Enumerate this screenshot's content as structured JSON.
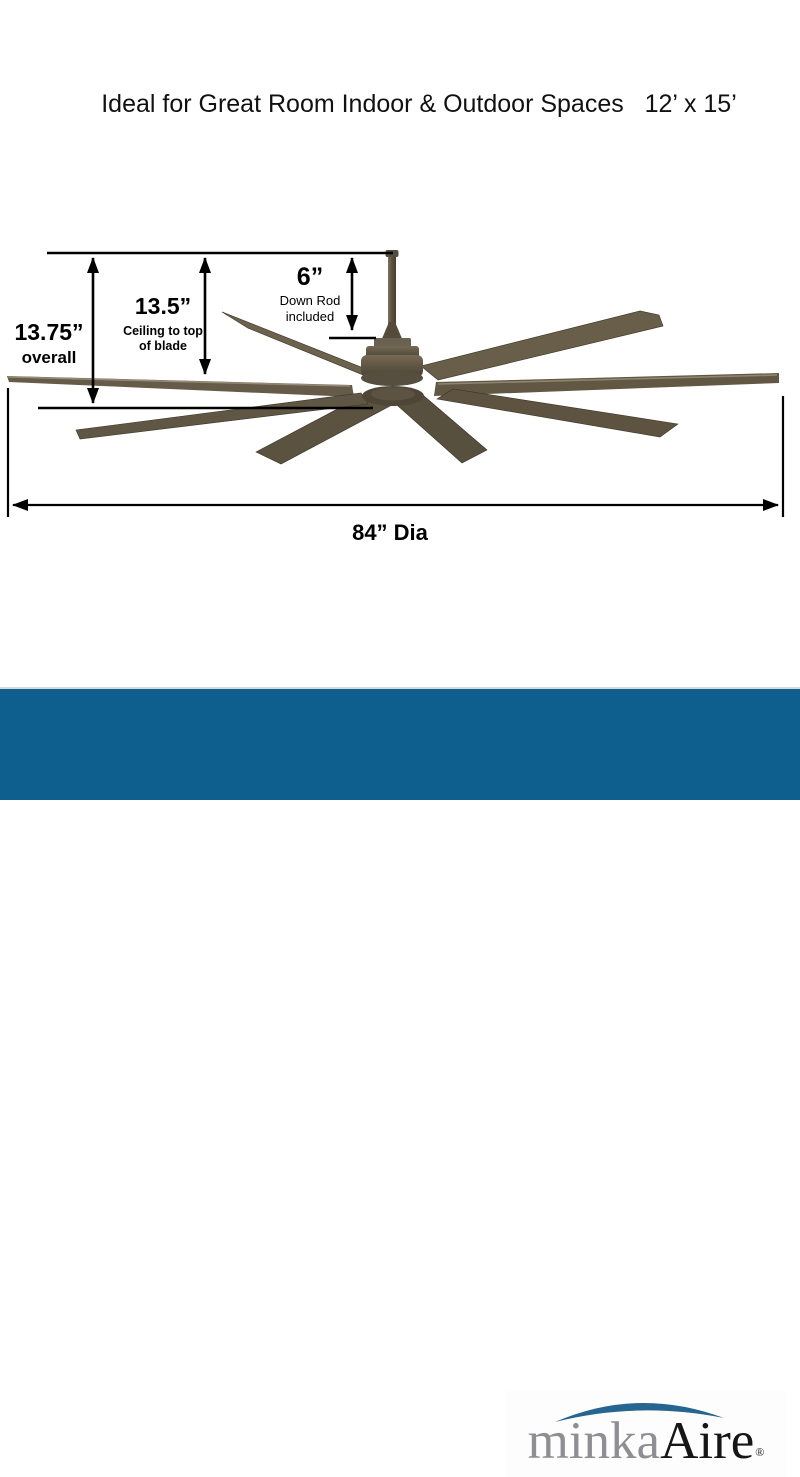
{
  "title": "Ideal for Great Room Indoor & Outdoor Spaces   12’ x 15’",
  "dimensions": {
    "down_rod": {
      "value": "6”",
      "line1": "Down Rod",
      "line2": "included"
    },
    "ceiling_to_blade": {
      "value": "13.5”",
      "line1": "Ceiling to top",
      "line2": "of blade"
    },
    "overall": {
      "value": "13.75”",
      "label": "overall"
    },
    "diameter": {
      "value": "84” Dia"
    }
  },
  "product": {
    "kind": "ceiling-fan-dimension-diagram",
    "blade_count": 8,
    "finish_color": "#5f5747"
  },
  "colors": {
    "dimension_lines": "#000000",
    "footer_bar": "#0f5f8e",
    "logo_minka_gray": "#8f8f93",
    "logo_aire_black": "#161616",
    "logo_swoosh_blue": "#26658f"
  },
  "footer": {
    "brand_minka": "minka",
    "brand_aire": "Aire",
    "registered_mark": "®"
  }
}
